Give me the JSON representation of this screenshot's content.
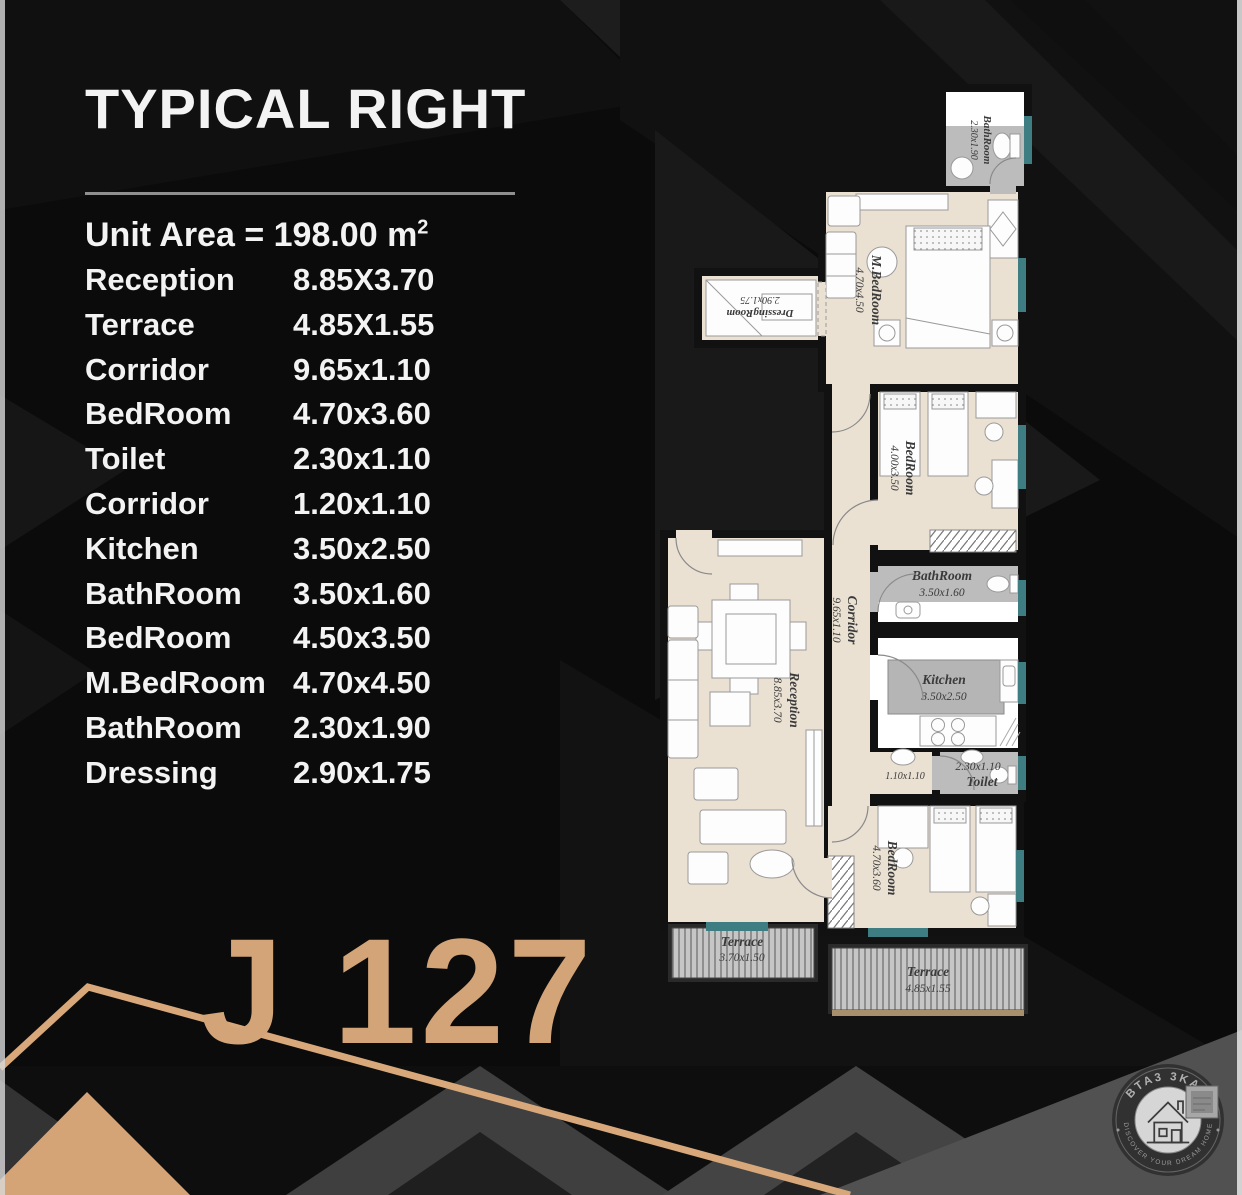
{
  "title": "TYPICAL RIGHT",
  "unit_area": {
    "text": "Unit Area = 198.00 m",
    "sup": "2"
  },
  "rooms": [
    {
      "label": "Reception",
      "dims": "8.85X3.70"
    },
    {
      "label": "Terrace",
      "dims": "4.85X1.55"
    },
    {
      "label": "Corridor",
      "dims": "9.65x1.10"
    },
    {
      "label": "BedRoom",
      "dims": "4.70x3.60"
    },
    {
      "label": "Toilet",
      "dims": "2.30x1.10"
    },
    {
      "label": "Corridor",
      "dims": "1.20x1.10"
    },
    {
      "label": "Kitchen",
      "dims": "3.50x2.50"
    },
    {
      "label": "BathRoom",
      "dims": "3.50x1.60"
    },
    {
      "label": "BedRoom",
      "dims": "4.50x3.50"
    },
    {
      "label": "M.BedRoom",
      "dims": "4.70x4.50"
    },
    {
      "label": "BathRoom",
      "dims": "2.30x1.90"
    },
    {
      "label": "Dressing",
      "dims": "2.90x1.75"
    }
  ],
  "unit_code": "J 127",
  "plan": {
    "bathroom_top": {
      "name": "BathRoom",
      "dims": "2.30x1.90"
    },
    "master_bedroom": {
      "name": "M.BedRoom",
      "dims": "4.70x4.50"
    },
    "dressing_room": {
      "name": "DressingRoom",
      "dims": "2.90x1.75"
    },
    "bedroom_middle": {
      "name": "BedRoom",
      "dims": "4.00x3.50"
    },
    "corridor": {
      "name": "Corridor",
      "dims": "9.65x1.10"
    },
    "bathroom_middle": {
      "name": "BathRoom",
      "dims": "3.50x1.60"
    },
    "kitchen": {
      "name": "Kitchen",
      "dims": "3.50x2.50"
    },
    "corridor_small": {
      "dims": "1.10x1.10"
    },
    "toilet": {
      "name": "Toilet",
      "dims": "2.30x1.10"
    },
    "bedroom_bottom": {
      "name": "BedRoom",
      "dims": "4.70x3.60"
    },
    "reception": {
      "name": "Reception",
      "dims": "8.85x3.70"
    },
    "terrace_left": {
      "name": "Terrace",
      "dims": "3.70x1.50"
    },
    "terrace_right": {
      "name": "Terrace",
      "dims": "4.85x1.55"
    }
  },
  "logo": {
    "brand": "BTA3 3KAR",
    "tagline": "DISCOVER YOUR DREAM HOME"
  },
  "colors": {
    "accent_gold": "#d2a478",
    "floor_beige": "#eae1d3",
    "wet_gray": "#bcbcbc",
    "window_teal": "#3e7d82",
    "wall_black": "#111111"
  }
}
